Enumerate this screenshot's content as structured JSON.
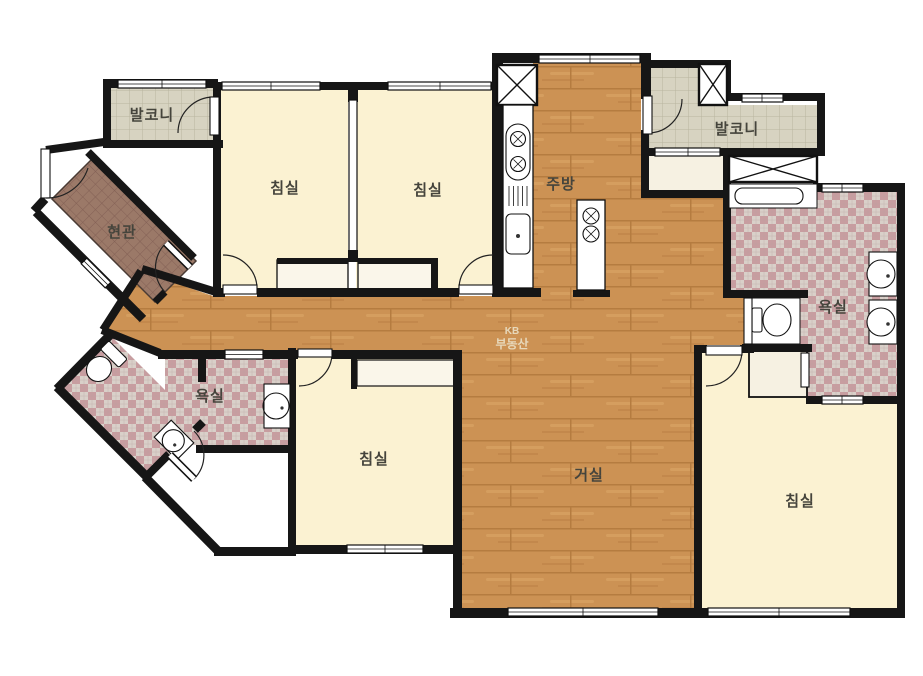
{
  "type": "apartment-floor-plan",
  "labels": {
    "balcony_tl": "발코니",
    "bedroom_1": "침실",
    "bedroom_2": "침실",
    "kitchen": "주방",
    "balcony_tr": "발코니",
    "entrance": "현관",
    "bathroom_right": "욕실",
    "bathroom_left": "욕실",
    "bedroom_3": "침실",
    "living": "거실",
    "bedroom_4": "침실"
  },
  "watermark": {
    "line1": "KB",
    "line2": "부동산"
  },
  "colors": {
    "wall": "#161616",
    "wood": "#cc9254",
    "bedroom": "#fbf2d2",
    "balcony_tile": "#d7d3c1",
    "bath_tile_a": "#c89da0",
    "bath_tile_b": "#d9d0c9",
    "entrance_tile": "#9b7968",
    "closet": "#f6f1e2",
    "label": "#45443c",
    "watermark": "#e9dcc0"
  }
}
